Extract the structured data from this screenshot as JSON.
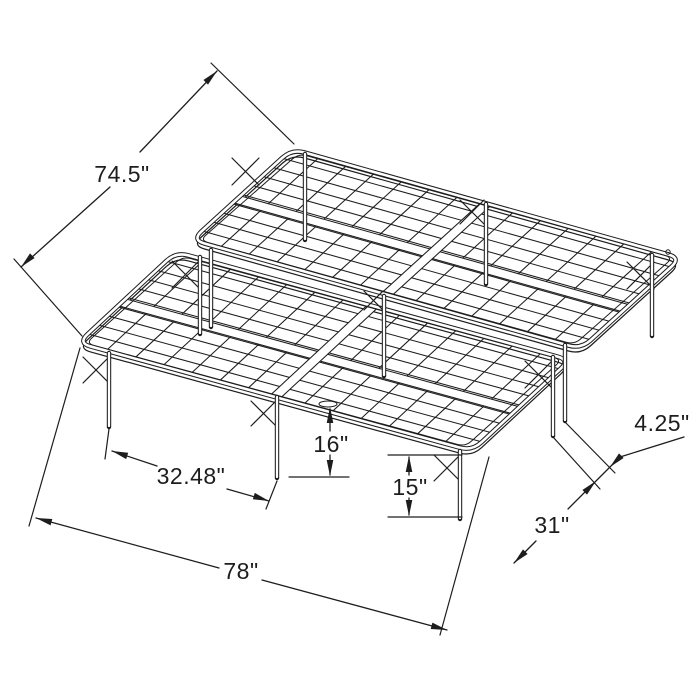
{
  "diagram": {
    "type": "isometric dimension drawing",
    "subject": "two-piece metal platform bed frame with wire grid deck and folding legs",
    "background_color": "#ffffff",
    "line_color": "#1d1d1d",
    "unit": "inches",
    "dimensions": [
      {
        "name": "upper-left-edge-width",
        "label": "74.5\""
      },
      {
        "name": "front-edge-length",
        "label": "78\""
      },
      {
        "name": "front-left-leg-spacing",
        "label": "32.48\""
      },
      {
        "name": "center-underbed-clearance",
        "label": "16\""
      },
      {
        "name": "front-leg-height",
        "label": "15\""
      },
      {
        "name": "right-edge-leg-spacing",
        "label": "31\""
      },
      {
        "name": "seam-leg-gap",
        "label": "4.25\""
      }
    ]
  }
}
